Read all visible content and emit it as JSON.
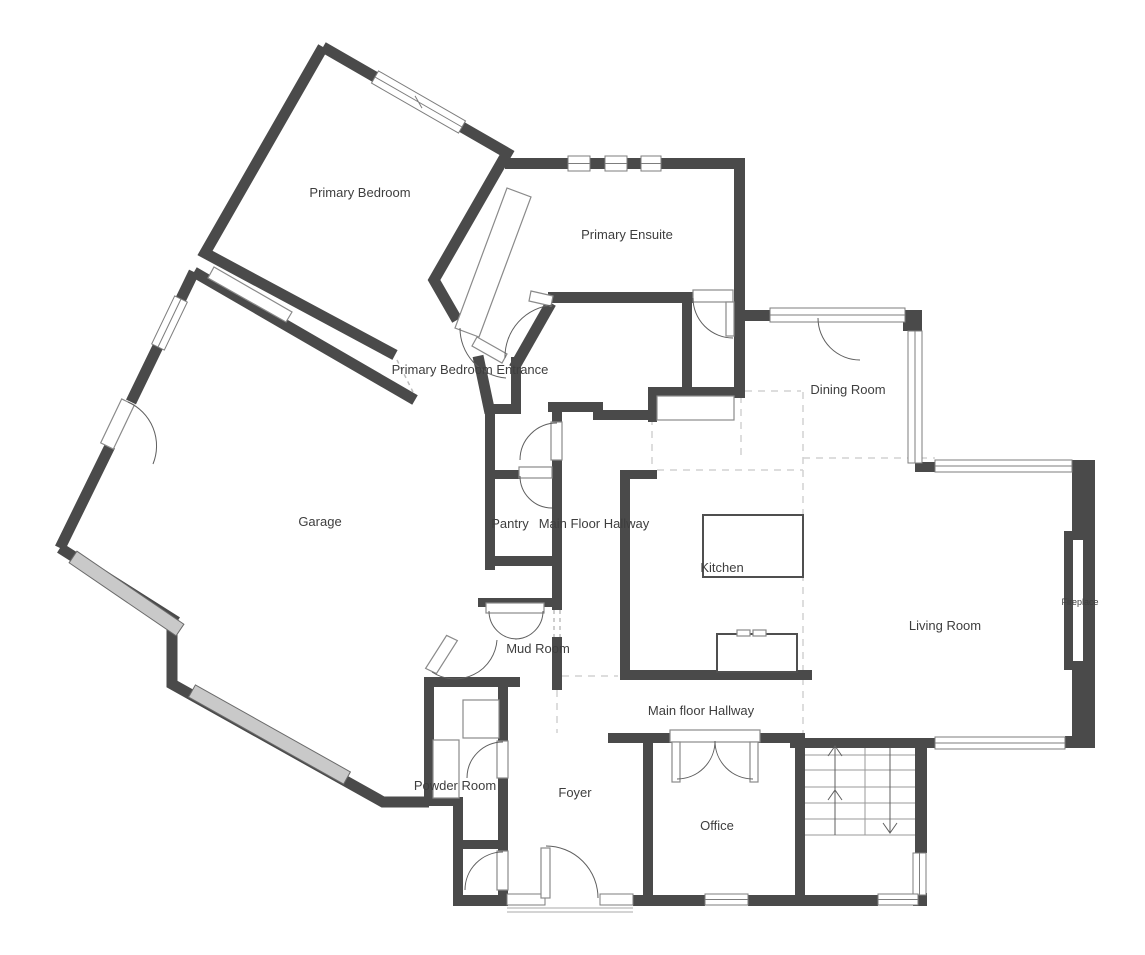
{
  "labels": {
    "primary_bedroom": "Primary Bedroom",
    "primary_ensuite": "Primary Ensuite",
    "primary_bedroom_entrance": "Primary Bedroom Entrance",
    "garage": "Garage",
    "pantry": "Pantry",
    "main_floor_hallway_upper": "Main Floor Hallway",
    "dining_room": "Dining Room",
    "kitchen": "Kitchen",
    "living_room": "Living Room",
    "fireplace": "Fireplace",
    "mud_room": "Mud Room",
    "main_floor_hallway_lower": "Main floor Hallway",
    "powder_room": "Powder Room",
    "foyer": "Foyer",
    "office": "Office"
  },
  "colors": {
    "wall": "#4a4a4a",
    "fixture_stroke": "#8a8a8a",
    "garage_door_fill": "#c9c9c9",
    "dashed_boundary": "#d2d2d2",
    "label_text": "#3e3e3e",
    "background": "#ffffff"
  }
}
